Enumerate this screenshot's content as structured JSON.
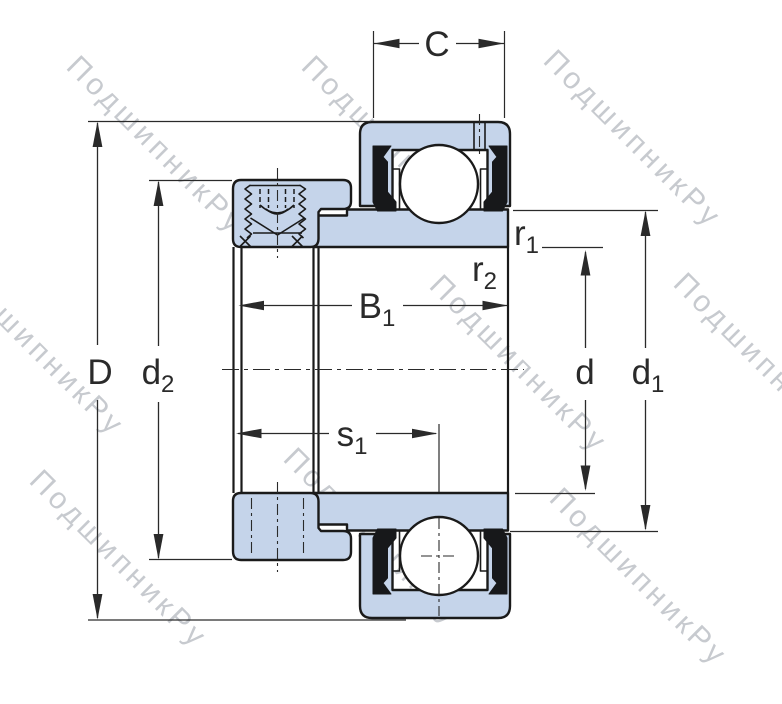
{
  "watermark": {
    "text": "ПодшипникРу"
  },
  "colors": {
    "body_fill": "#c5d4ea",
    "outline": "#1a1a1a",
    "dimension": "#2a2a2a",
    "seal": "#17181a",
    "watermark": "#9aa0a8",
    "background": "#ffffff"
  },
  "labels": {
    "C": {
      "main": "C",
      "sub": ""
    },
    "D": {
      "main": "D",
      "sub": ""
    },
    "d2": {
      "main": "d",
      "sub": "2"
    },
    "B1": {
      "main": "B",
      "sub": "1"
    },
    "s1": {
      "main": "s",
      "sub": "1"
    },
    "r1": {
      "main": "r",
      "sub": "1"
    },
    "r2": {
      "main": "r",
      "sub": "2"
    },
    "d": {
      "main": "d",
      "sub": ""
    },
    "d1": {
      "main": "d",
      "sub": "1"
    }
  }
}
